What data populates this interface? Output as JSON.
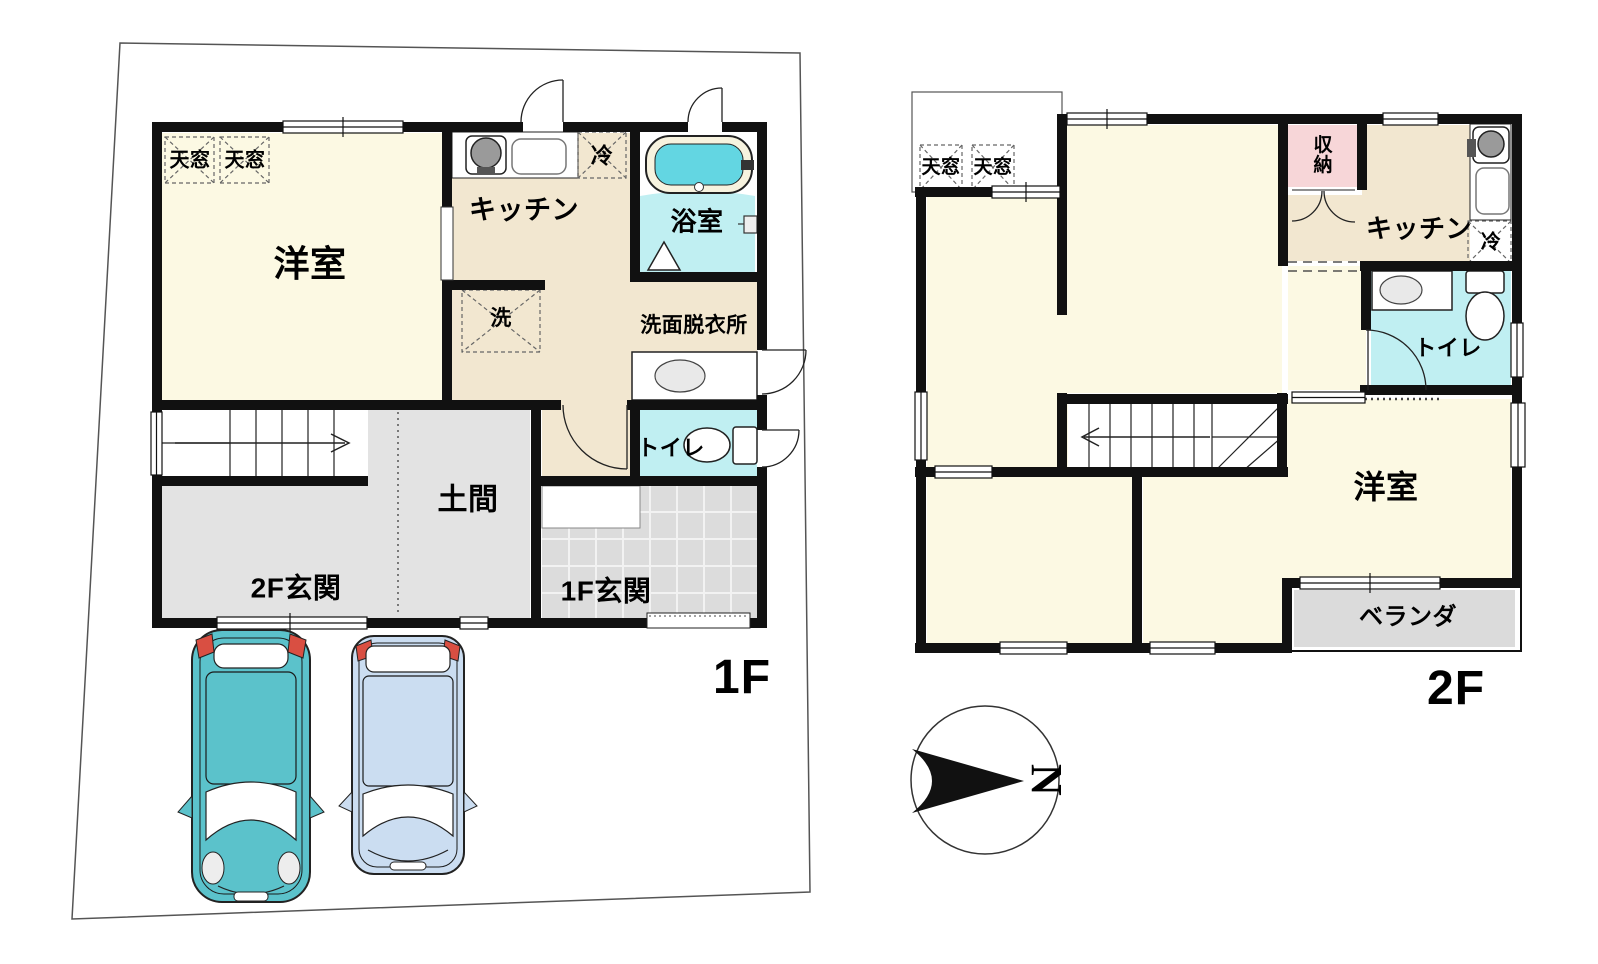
{
  "floor1": {
    "floor_label": "1F",
    "rooms": {
      "skylight1": "天窓",
      "skylight2": "天窓",
      "western_room": "洋室",
      "kitchen": "キッチン",
      "fridge": "冷",
      "bath": "浴室",
      "washer": "洗",
      "washroom": "洗面脱衣所",
      "toilet": "トイレ",
      "doma": "土間",
      "entrance_2f": "2F玄関",
      "entrance_1f": "1F玄関"
    }
  },
  "floor2": {
    "floor_label": "2F",
    "rooms": {
      "skylight1": "天窓",
      "skylight2": "天窓",
      "storage": "収納",
      "kitchen": "キッチン",
      "fridge": "冷",
      "toilet": "トイレ",
      "western_room": "洋室",
      "veranda": "ベランダ"
    }
  },
  "compass": {
    "north": "N"
  },
  "colors": {
    "room_cream": "#FCF9E3",
    "kitchen_beige": "#F2E7D0",
    "water_cyan": "#C0EFF2",
    "tub_cyan": "#63D6E2",
    "storage_pink": "#F7D6D8",
    "floor_gray": "#E3E3E3",
    "tile_gray": "#DCDCDC",
    "veranda_gray": "#DBDBDB",
    "car_teal": "#5BC2CB",
    "car_blue": "#CBDDF1",
    "wall_black": "#111111"
  }
}
